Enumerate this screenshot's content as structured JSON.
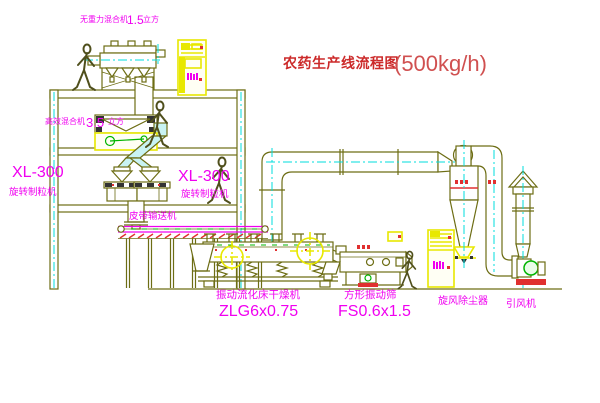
{
  "title": {
    "text": "农药生产线流程图",
    "capacity": "(500kg/h)"
  },
  "equipment_labels": {
    "gravity_free_mixer": {
      "name": "无重力混合机",
      "size": "1.5",
      "unit": "立方"
    },
    "high_efficiency_mixer": {
      "name": "高效混合机",
      "size": "3.5",
      "unit": "立方"
    },
    "granulator_left": {
      "model": "XL-300",
      "name": "旋转制粒机"
    },
    "granulator_middle": {
      "model": "XL-300",
      "name": "旋转制粒机"
    },
    "belt_conveyor": {
      "name": "皮带输送机"
    },
    "fluid_bed_dryer": {
      "name": "振动流化床干燥机",
      "model": "ZLG6x0.75"
    },
    "vibrating_screen": {
      "name": "方形振动筛",
      "model": "FS0.6x1.5"
    },
    "cyclone": {
      "name": "旋风除尘器"
    },
    "induced_draft_fan": {
      "name": "引风机"
    }
  },
  "colors": {
    "line_olive": "#6d6d14",
    "centerline_cyan": "#00dede",
    "cabinet_yellow": "#e8e800",
    "label_magenta": "#f000f0",
    "detail_red": "#e03030",
    "detail_green": "#00b400",
    "title_red": "#cc2a2a",
    "background": "#ffffff"
  }
}
